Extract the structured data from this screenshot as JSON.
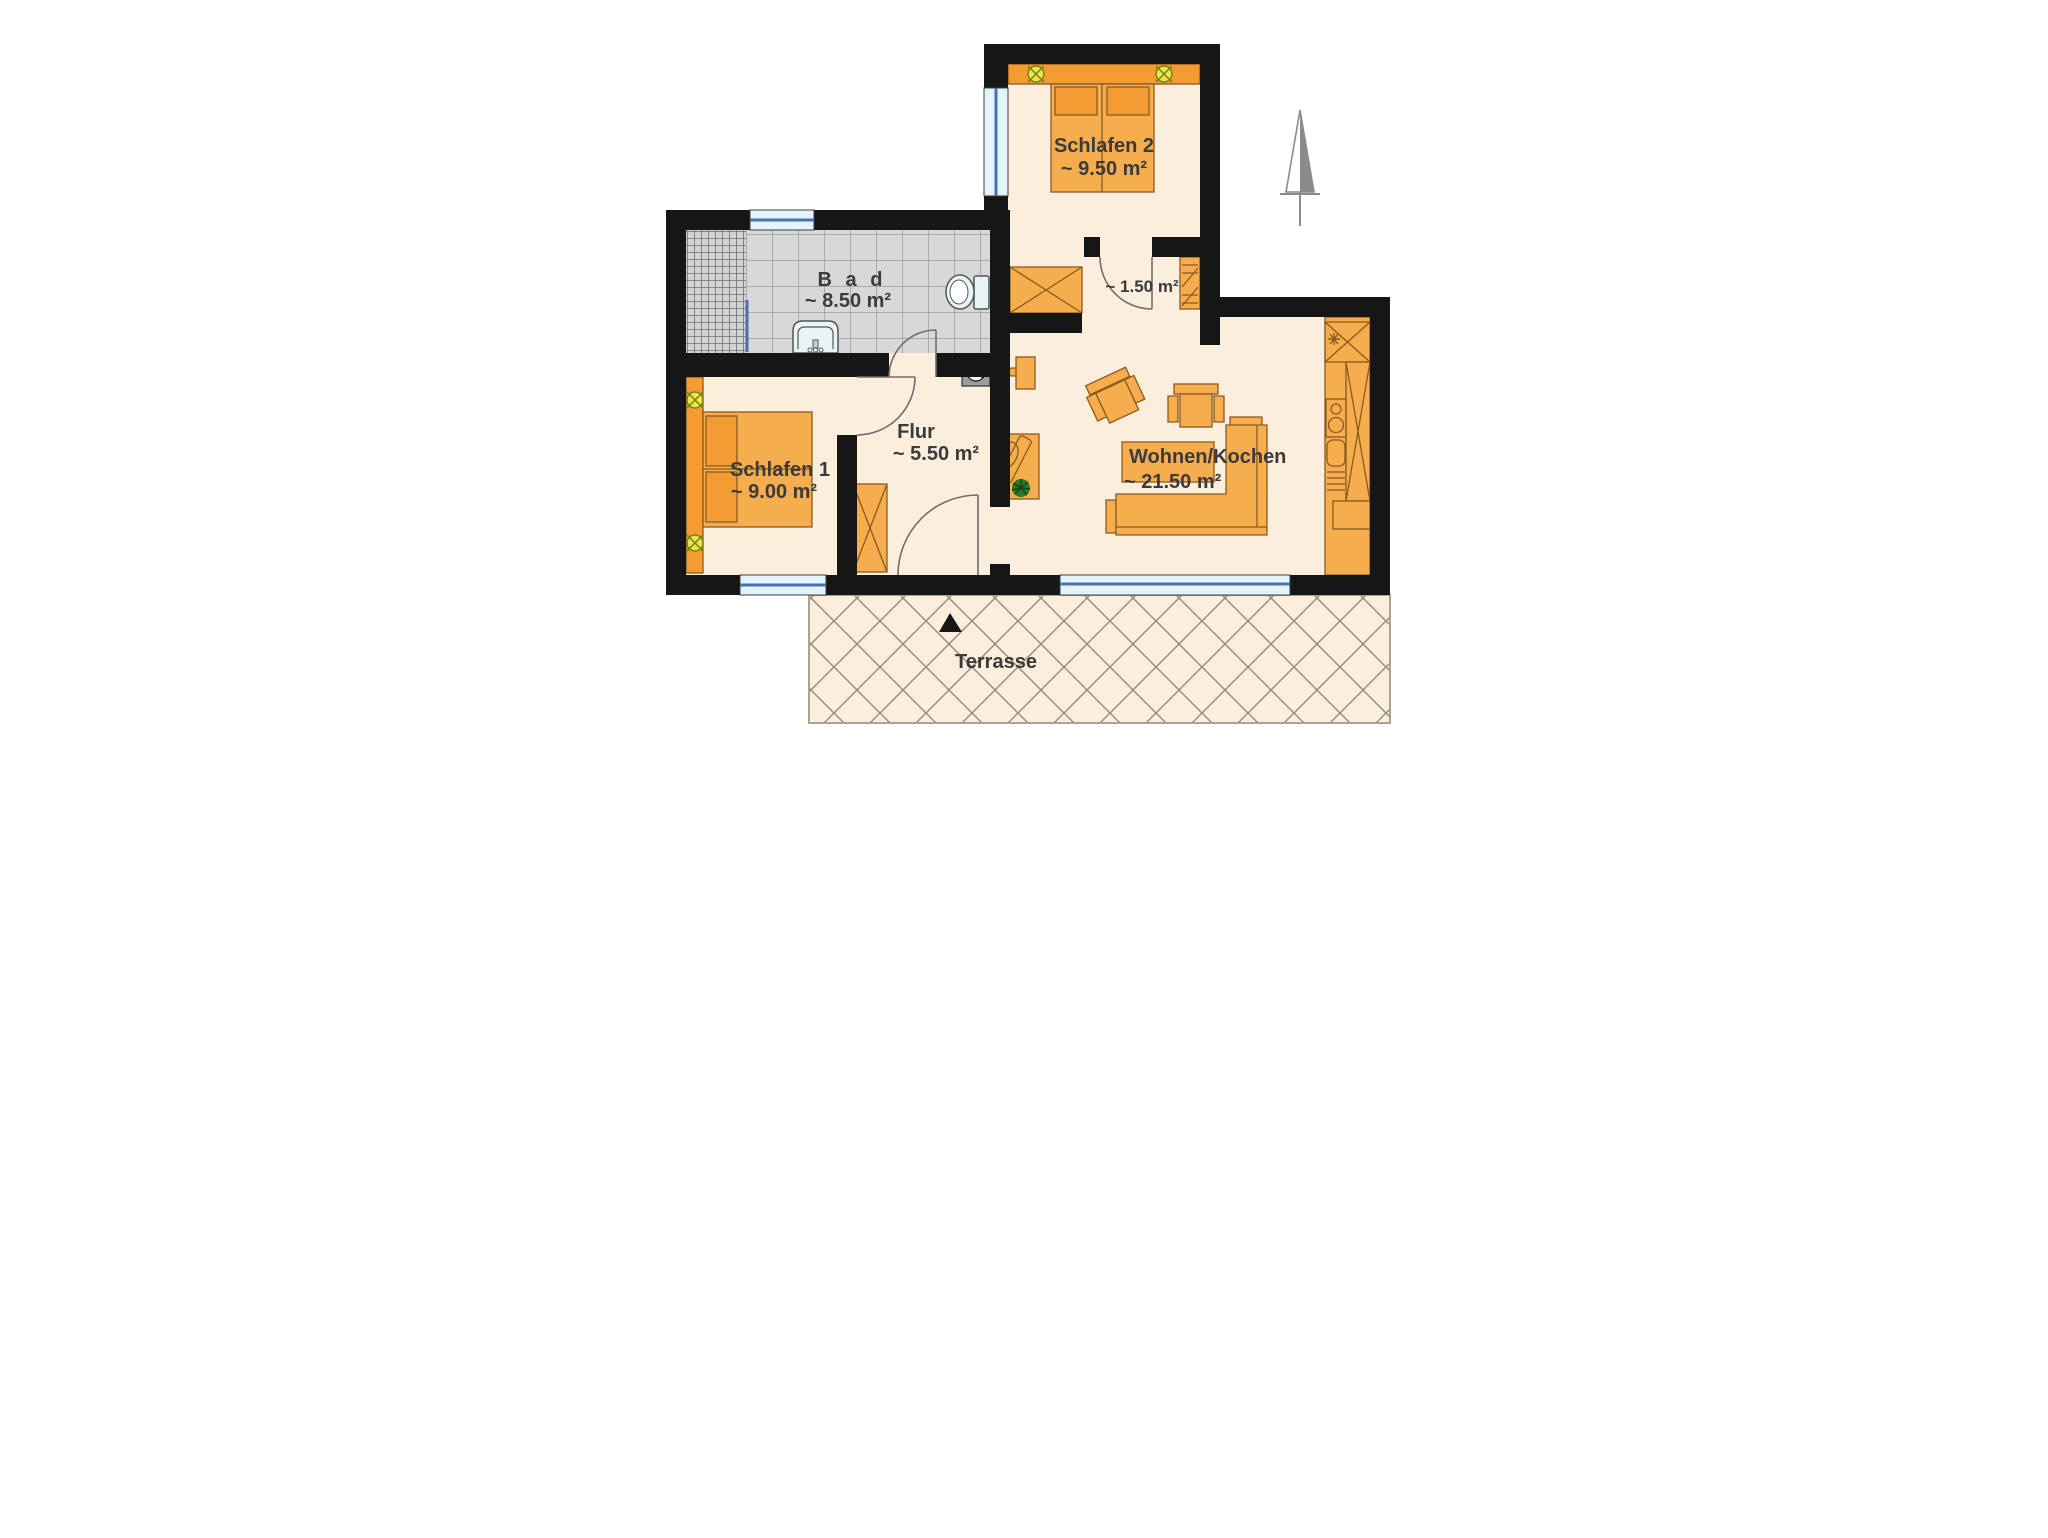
{
  "plan": {
    "type": "apartment-floor-plan",
    "rooms": {
      "schlafen2": {
        "name": "Schlafen 2",
        "area": "~ 9.50 m²"
      },
      "bad": {
        "name": "B a d",
        "area": "~ 8.50 m²"
      },
      "vestibule": {
        "area": "~ 1.50 m²"
      },
      "flur": {
        "name": "Flur",
        "area": "~ 5.50 m²"
      },
      "schlafen1": {
        "name": "Schlafen 1",
        "area": "~ 9.00 m²"
      },
      "wohnen": {
        "name": "Wohnen/Kochen",
        "area": "~ 21.50 m²"
      },
      "terrasse": {
        "name": "Terrasse"
      }
    },
    "colors": {
      "wall": "#161616",
      "floor_cream": "#FBEEDC",
      "furniture_orange": "#F5AD4E",
      "furniture_dark_orange": "#F29C33",
      "tile_gray": "#D8D8D8",
      "window_glass": "#E4F4FB",
      "window_frame_blue": "#4a6fae",
      "lamp_yellow": "#E9E64A",
      "plant_green": "#2F7A28",
      "north_arrow_gray": "#8b8b8b"
    }
  }
}
